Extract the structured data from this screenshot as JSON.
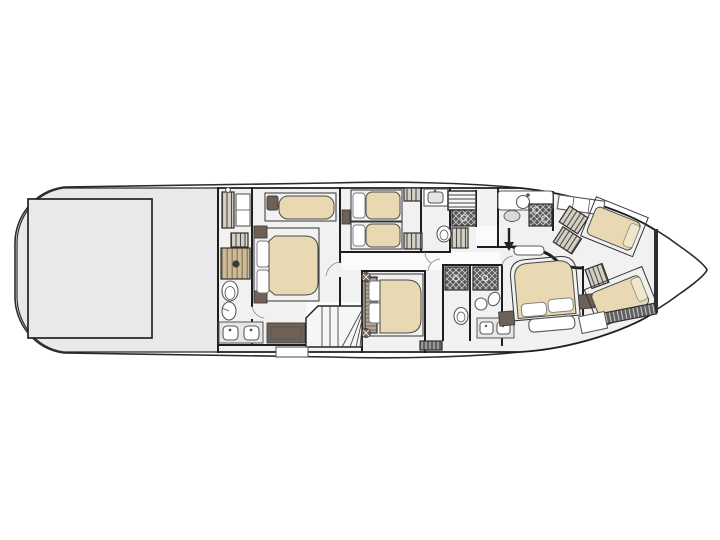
{
  "image": {
    "kind": "yacht-lower-deck-floor-plan",
    "orientation": "bow-right-stern-left",
    "background": "#ffffff"
  },
  "palette": {
    "hull_outline": "#2b2b2b",
    "wall": "#1e1e1e",
    "platform_fill": "#e9e9eb",
    "interior_fill": "#f1f1f2",
    "corridor_fill": "#fbfbfc",
    "mattress_fill": "#e8d9b3",
    "mattress_edge": "#4a4a4a",
    "pillow_fill": "#ffffff",
    "cushion_cream": "#f0e6cc",
    "dark_wood": "#6f6156",
    "fixture_stroke": "#5a5a5a",
    "fixture_fill": "#ffffff",
    "vanity_fill": "#e6e6e8",
    "shower_dark": "#585858",
    "hatch_wood_light": "#d6d0c4",
    "hatch_wood_dark": "#4a4a4a",
    "shower_wood_light": "#cdbb97",
    "shower_wood_dark": "#8d7a5e",
    "headboard_light": "#b3a693",
    "headboard_dark": "#6f6459",
    "slat_dark": "#606060",
    "slat_light": "#d0d0d0"
  },
  "rooms": [
    {
      "id": "swim-platform",
      "name": "aft platform / tender garage",
      "furniture": [
        "garage-hatch"
      ]
    },
    {
      "id": "master-bathroom",
      "name": "master bathroom (port strip)",
      "furniture": [
        "wardrobe",
        "cabinet",
        "tv-cabinet",
        "shower",
        "toilet",
        "bidet",
        "double-sink-vanity"
      ]
    },
    {
      "id": "master-cabin",
      "name": "full-beam master cabin",
      "furniture": [
        "chaise-longue",
        "double-bed",
        "pillows",
        "nightstands",
        "dresser-bench",
        "winder-staircase"
      ]
    },
    {
      "id": "twin-cabin",
      "name": "twin guest cabin",
      "furniture": [
        "single-bed",
        "single-bed",
        "speaker",
        "wardrobes"
      ]
    },
    {
      "id": "twin-bathroom",
      "name": "guest bathroom",
      "furniture": [
        "washbasin-cabinet",
        "toilet"
      ]
    },
    {
      "id": "lobby",
      "name": "midship lobby",
      "furniture": [
        "main-staircase",
        "under-stair-shower",
        "linen-closet",
        "direction-arrow",
        "threshold-step"
      ]
    },
    {
      "id": "galley",
      "name": "lower galley",
      "furniture": [
        "counter",
        "round-sink",
        "basin",
        "cooktop"
      ]
    },
    {
      "id": "guest-double-cabin",
      "name": "guest double cabin",
      "furniture": [
        "double-bed",
        "headboard",
        "pillows",
        "corner-speakers",
        "vent-grille"
      ]
    },
    {
      "id": "forward-bathrooms",
      "name": "forward bathrooms",
      "furniture": [
        "shower",
        "shower",
        "toilet",
        "washbasin",
        "wc-oval",
        "vanity-with-basins"
      ]
    },
    {
      "id": "vip-bow-cabin",
      "name": "VIP bow cabin",
      "furniture": [
        "double-bed",
        "pillows",
        "nightstands",
        "foot-bench"
      ]
    },
    {
      "id": "crew-cabin",
      "name": "crew quarters",
      "furniture": [
        "companionway-steps",
        "hull-cabinets",
        "single-berth",
        "single-berth",
        "locker",
        "slatted-step",
        "cabinet"
      ]
    },
    {
      "id": "bow-locker",
      "name": "forepeak locker",
      "furniture": []
    }
  ]
}
